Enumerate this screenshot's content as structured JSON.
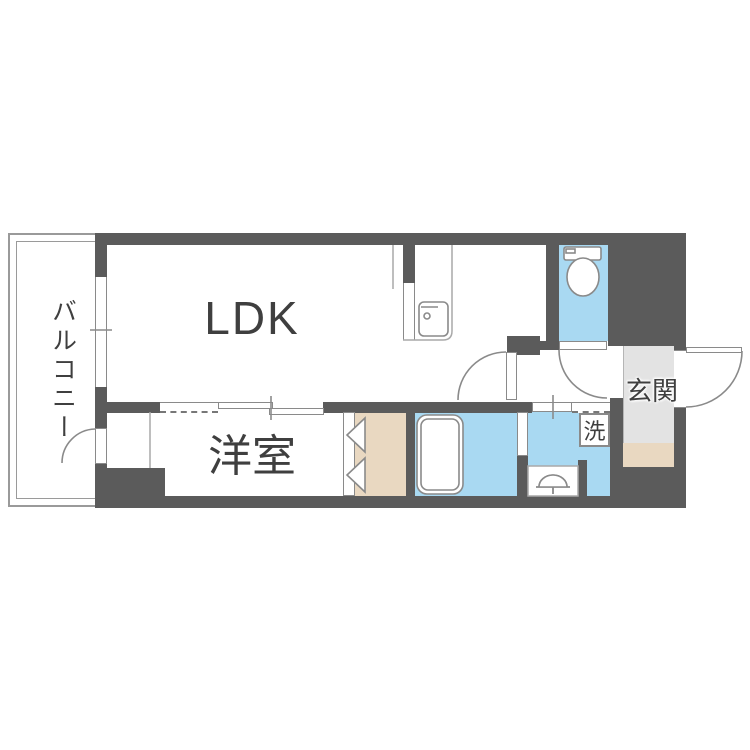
{
  "plan_type": "apartment-floor-plan",
  "labels": {
    "ldk": "LDK",
    "bedroom": "洋室",
    "balcony": "バルコニー",
    "entrance": "玄関",
    "laundry": "洗"
  },
  "colors": {
    "wall": "#5b5b5b",
    "water": "#a9d9f2",
    "wood": "#e9d8c1",
    "tile": "#e3e3e3",
    "line": "#8a8a8a",
    "text": "#3f3f3f"
  }
}
